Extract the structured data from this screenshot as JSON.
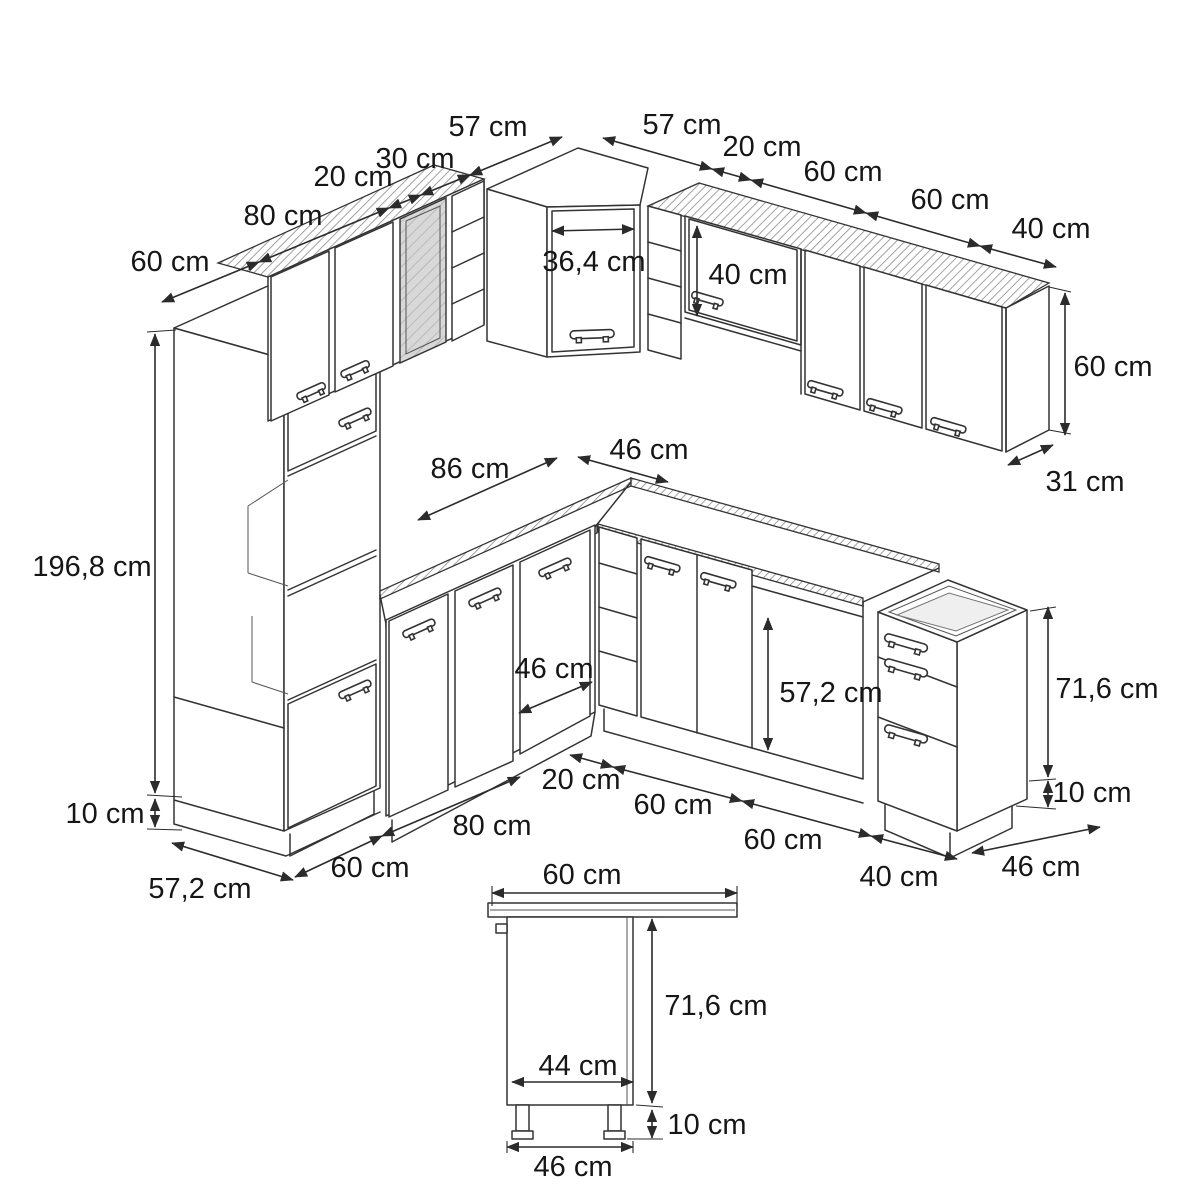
{
  "diagram": {
    "background": "#ffffff",
    "line_color": "#333333",
    "text_color": "#161616",
    "glass_fill": "#d8d8d8"
  },
  "dims": {
    "tl_depth60": "60 cm",
    "tl_80": "80 cm",
    "tl_20": "20 cm",
    "tl_30": "30 cm",
    "tl_57": "57 cm",
    "tr_57": "57 cm",
    "tr_20": "20 cm",
    "tr_60a": "60 cm",
    "tr_60b": "60 cm",
    "tr_40": "40 cm",
    "corner_door_w": "36,4 cm",
    "right_upper_door_h": "40 cm",
    "wall_cab_h": "60 cm",
    "wall_cab_d": "31 cm",
    "worktop_left": "86 cm",
    "worktop_right": "46 cm",
    "tall_h": "196,8 cm",
    "plinth_left": "10 cm",
    "corner_base_d": "46 cm",
    "niche_h": "57,2 cm",
    "base_h": "71,6 cm",
    "plinth_right": "10 cm",
    "bottom_20": "20 cm",
    "bottom_60a": "60 cm",
    "bottom_60b": "60 cm",
    "bottom_40": "40 cm",
    "base_d": "46 cm",
    "bl_60": "60 cm",
    "bl_80": "80 cm",
    "tall_d": "57,2 cm",
    "det_top_w": "60 cm",
    "det_h": "71,6 cm",
    "det_inner_w": "44 cm",
    "det_legs": "10 cm",
    "det_w": "46 cm"
  }
}
